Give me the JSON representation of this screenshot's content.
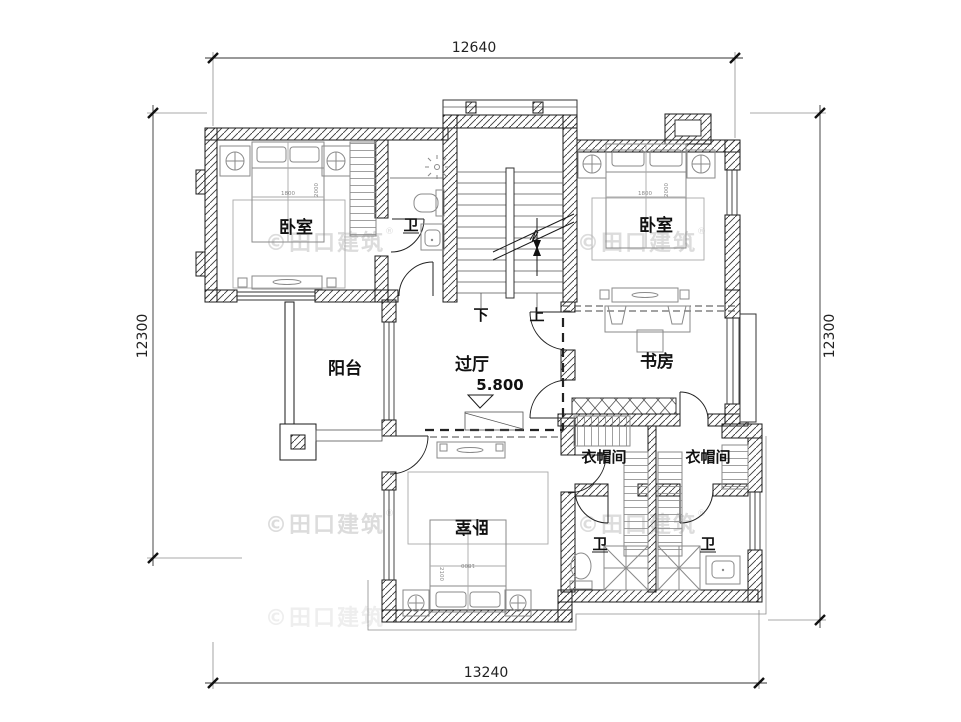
{
  "watermark": {
    "text": "©田口建筑",
    "registered": "®"
  },
  "dimensions": {
    "top": "12640",
    "bottom": "13240",
    "left": "12300",
    "right": "12300"
  },
  "elevation_label": "5.800",
  "rooms": {
    "bedroom_nw": "卧室",
    "bath_nw": "卫",
    "bedroom_ne": "卧室",
    "balcony": "阳台",
    "hall": "过厅",
    "study": "书房",
    "cloakroom_left": "衣帽间",
    "cloakroom_right": "衣帽间",
    "bedroom_s": "卧室",
    "bath_s_left": "卫",
    "bath_s_right": "卫"
  },
  "stairs": {
    "down": "下",
    "up": "上"
  },
  "bed_dims": {
    "width": "1800",
    "depth_nw": "2000",
    "depth_s": "2100"
  }
}
